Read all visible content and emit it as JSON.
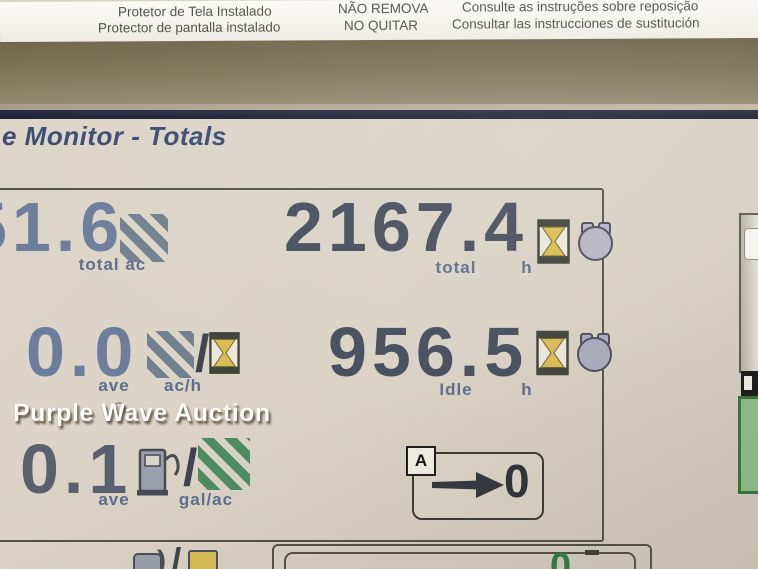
{
  "sticker": {
    "pt_line1": "Protetor de Tela Instalado",
    "es_line1": "Protector de pantalla instalado",
    "pt_warn": "NÃO REMOVA",
    "es_warn": "NO QUITAR",
    "pt_note": "Consulte as instruções sobre reposição",
    "es_note": "Consultar las instrucciones de sustitución"
  },
  "screen": {
    "title": "e Monitor - Totals"
  },
  "stats": {
    "total_area": {
      "value": "51.6",
      "label": "total ac"
    },
    "total_hours": {
      "value": "2167.4",
      "label_word": "total",
      "label_unit": "h"
    },
    "ave_area_rate": {
      "value": "0.0",
      "label_word": "ave",
      "label_unit": "ac/h"
    },
    "idle_hours": {
      "value": "956.5",
      "label_word": "Idle",
      "label_unit": "h"
    },
    "ave_fuel_rate": {
      "value": "0.1",
      "label_word": "ave",
      "label_unit": "gal/ac"
    },
    "unit_separator": "/"
  },
  "reset_button": {
    "softkey_label": "A",
    "value": "0"
  },
  "next_section": {
    "partial_value": "0"
  },
  "watermark": "Purple Wave Auction",
  "colors": {
    "value_blue": "#6c7e9c",
    "value_dark": "#464d5c",
    "label_blue": "#5d6e8c",
    "hatch_slate": "#72818f",
    "hatch_green": "#4d8d5f",
    "hourglass_gold": "#d9bc52",
    "engine_gray": "#aeb0c2",
    "screen_beige": "#d9d2c5",
    "title_navy": "#3e4d70",
    "partial_value_green": "#2f7e42"
  }
}
